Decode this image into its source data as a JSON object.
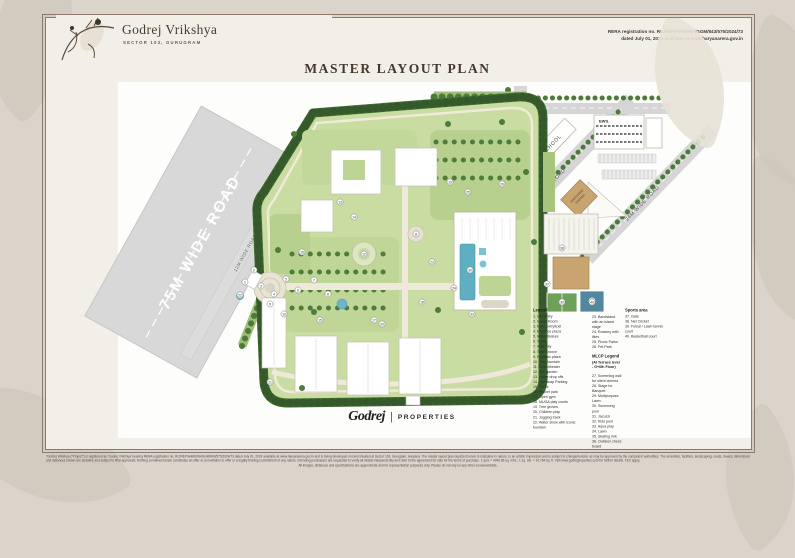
{
  "header": {
    "brand": "Godrej Vrikshya",
    "brand_sub": "SECTOR 103, GURUGRAM",
    "rera_line1": "RERA registration no. RC/REP/HARERA/GGM/843/575/2024/73",
    "rera_line2": "dated July 01, 2024 available at www.haryanarera.gov.in",
    "title": "MASTER LAYOUT PLAN"
  },
  "map": {
    "roads": {
      "r75": "75M WIDE ROAD",
      "r12": "12M WIDE ROAD",
      "r30": "30M WIDE ROAD",
      "r24": "24M WIDE ROAD",
      "r24v": "24M WIDE ROAD"
    },
    "blocks": {
      "school": "SCHOOL",
      "ews": "EWS.",
      "station_line1": "SWITCHING",
      "station_line2": "STATION"
    },
    "markers": [
      {
        "n": 1,
        "x": 243,
        "y": 280
      },
      {
        "n": 2,
        "x": 252,
        "y": 268
      },
      {
        "n": 3,
        "x": 259,
        "y": 284
      },
      {
        "n": 4,
        "x": 272,
        "y": 292
      },
      {
        "n": 5,
        "x": 284,
        "y": 277
      },
      {
        "n": 6,
        "x": 296,
        "y": 288
      },
      {
        "n": 7,
        "x": 312,
        "y": 278
      },
      {
        "n": 8,
        "x": 326,
        "y": 292
      },
      {
        "n": 9,
        "x": 268,
        "y": 302
      },
      {
        "n": 10,
        "x": 282,
        "y": 312
      },
      {
        "n": 11,
        "x": 414,
        "y": 232
      },
      {
        "n": 12,
        "x": 362,
        "y": 252
      },
      {
        "n": 13,
        "x": 338,
        "y": 200
      },
      {
        "n": 14,
        "x": 352,
        "y": 215
      },
      {
        "n": 15,
        "x": 318,
        "y": 318
      },
      {
        "n": 16,
        "x": 300,
        "y": 250
      },
      {
        "n": 17,
        "x": 372,
        "y": 318
      },
      {
        "n": 18,
        "x": 420,
        "y": 300
      },
      {
        "n": 19,
        "x": 448,
        "y": 180
      },
      {
        "n": 20,
        "x": 380,
        "y": 322
      },
      {
        "n": 21,
        "x": 268,
        "y": 380
      },
      {
        "n": 22,
        "x": 238,
        "y": 293
      },
      {
        "n": 23,
        "x": 430,
        "y": 260
      },
      {
        "n": 24,
        "x": 452,
        "y": 286
      },
      {
        "n": 25,
        "x": 466,
        "y": 190
      },
      {
        "n": 26,
        "x": 500,
        "y": 182
      },
      {
        "n": 30,
        "x": 468,
        "y": 268
      },
      {
        "n": 33,
        "x": 470,
        "y": 312
      },
      {
        "n": 37,
        "x": 545,
        "y": 282
      },
      {
        "n": 38,
        "x": 560,
        "y": 246
      },
      {
        "n": 39,
        "x": 560,
        "y": 300
      },
      {
        "n": 40,
        "x": 590,
        "y": 300
      }
    ]
  },
  "legend": {
    "heading": "Legend",
    "items_col1": [
      "1.  Site Entry",
      "2.  Guard Room",
      "3.  Main Entry/Exit",
      "4.  Entrance plaza",
      "5.  Water feature",
      "6.  Trellis",
      "7.  Walkway",
      "8.  Tree Groove",
      "9.  Fountain plaza",
      "10. Play fountain",
      "11. Amphitheater",
      "12. Zen garden",
      "13. Tower drop offs",
      "14. Handicap Parking",
      "15. Tot lot",
      "16. Pocket park",
      "17. Open gym",
      "18. MUGA play courts",
      "19. Tree groves",
      "20. Children play",
      "21. Jogging track",
      "22. Water show with iconic fountain"
    ],
    "items_col2a": [
      "23. Bandstand with an island stage",
      "24. Rockery with lilies",
      "25. Picnic Parks",
      "26. Pet Park"
    ],
    "mlcp_heading": "MLCP Legend",
    "mlcp_sub1": "(At Terrace level",
    "mlcp_sub2": "- G+6th Floor)",
    "items_col2b": [
      "27. Screening wall for silent cinema",
      "28. Stage for Banquet",
      "29. Multipurpose Lawn",
      "30. Swimming pool",
      "31. Jacuzzi",
      "32. Kids pool",
      "33. Aqua play",
      "34. Lawn",
      "35. Skating rink",
      "36. Outdoor chess board"
    ],
    "sports_heading": "Sports area",
    "items_col3": [
      "37. Gate",
      "38. Net Cricket",
      "39. Futsal / Lawn tennis court",
      "40. Basketball court"
    ]
  },
  "footer": {
    "logo_script": "Godrej",
    "logo_divider": "|",
    "logo_text": "PROPERTIES",
    "disclaimer_p1": "*Godrej Vrikshya (\"Project\") is registered as 'Godrej Vrikshya' bearing RERA registration no. RC/REP/HARERA/GGM/843/575/2024/73 dated July 01, 2024 available at www.haryanarera.gov.in and is being developed on land situated at Sector 103, Gurugram, Haryana. The master layout plan depicted herein is indicative in nature, is an artistic impression and is subject to change/revision as may be approved by the competent authorities. The amenities, facilities, landscaping, roads, towers, dimensions and distances shown are tentative and subject to final approvals. Nothing contained herein constitutes an offer or an invitation to offer or a legally binding commitment of any nature. Intending purchasers are requested to verify all details independently and refer to the agreement for sale for the terms of purchase. 1 acre = 4046.86 sq. mtrs.; 1 sq. mtr. = 10.764 sq. ft. Visit www.godrejproperties.com for further details. T&C apply.",
    "disclaimer_p2": "All images, distances and specifications are approximate and for representation purposes only. Please do not rely on any other source/website."
  }
}
